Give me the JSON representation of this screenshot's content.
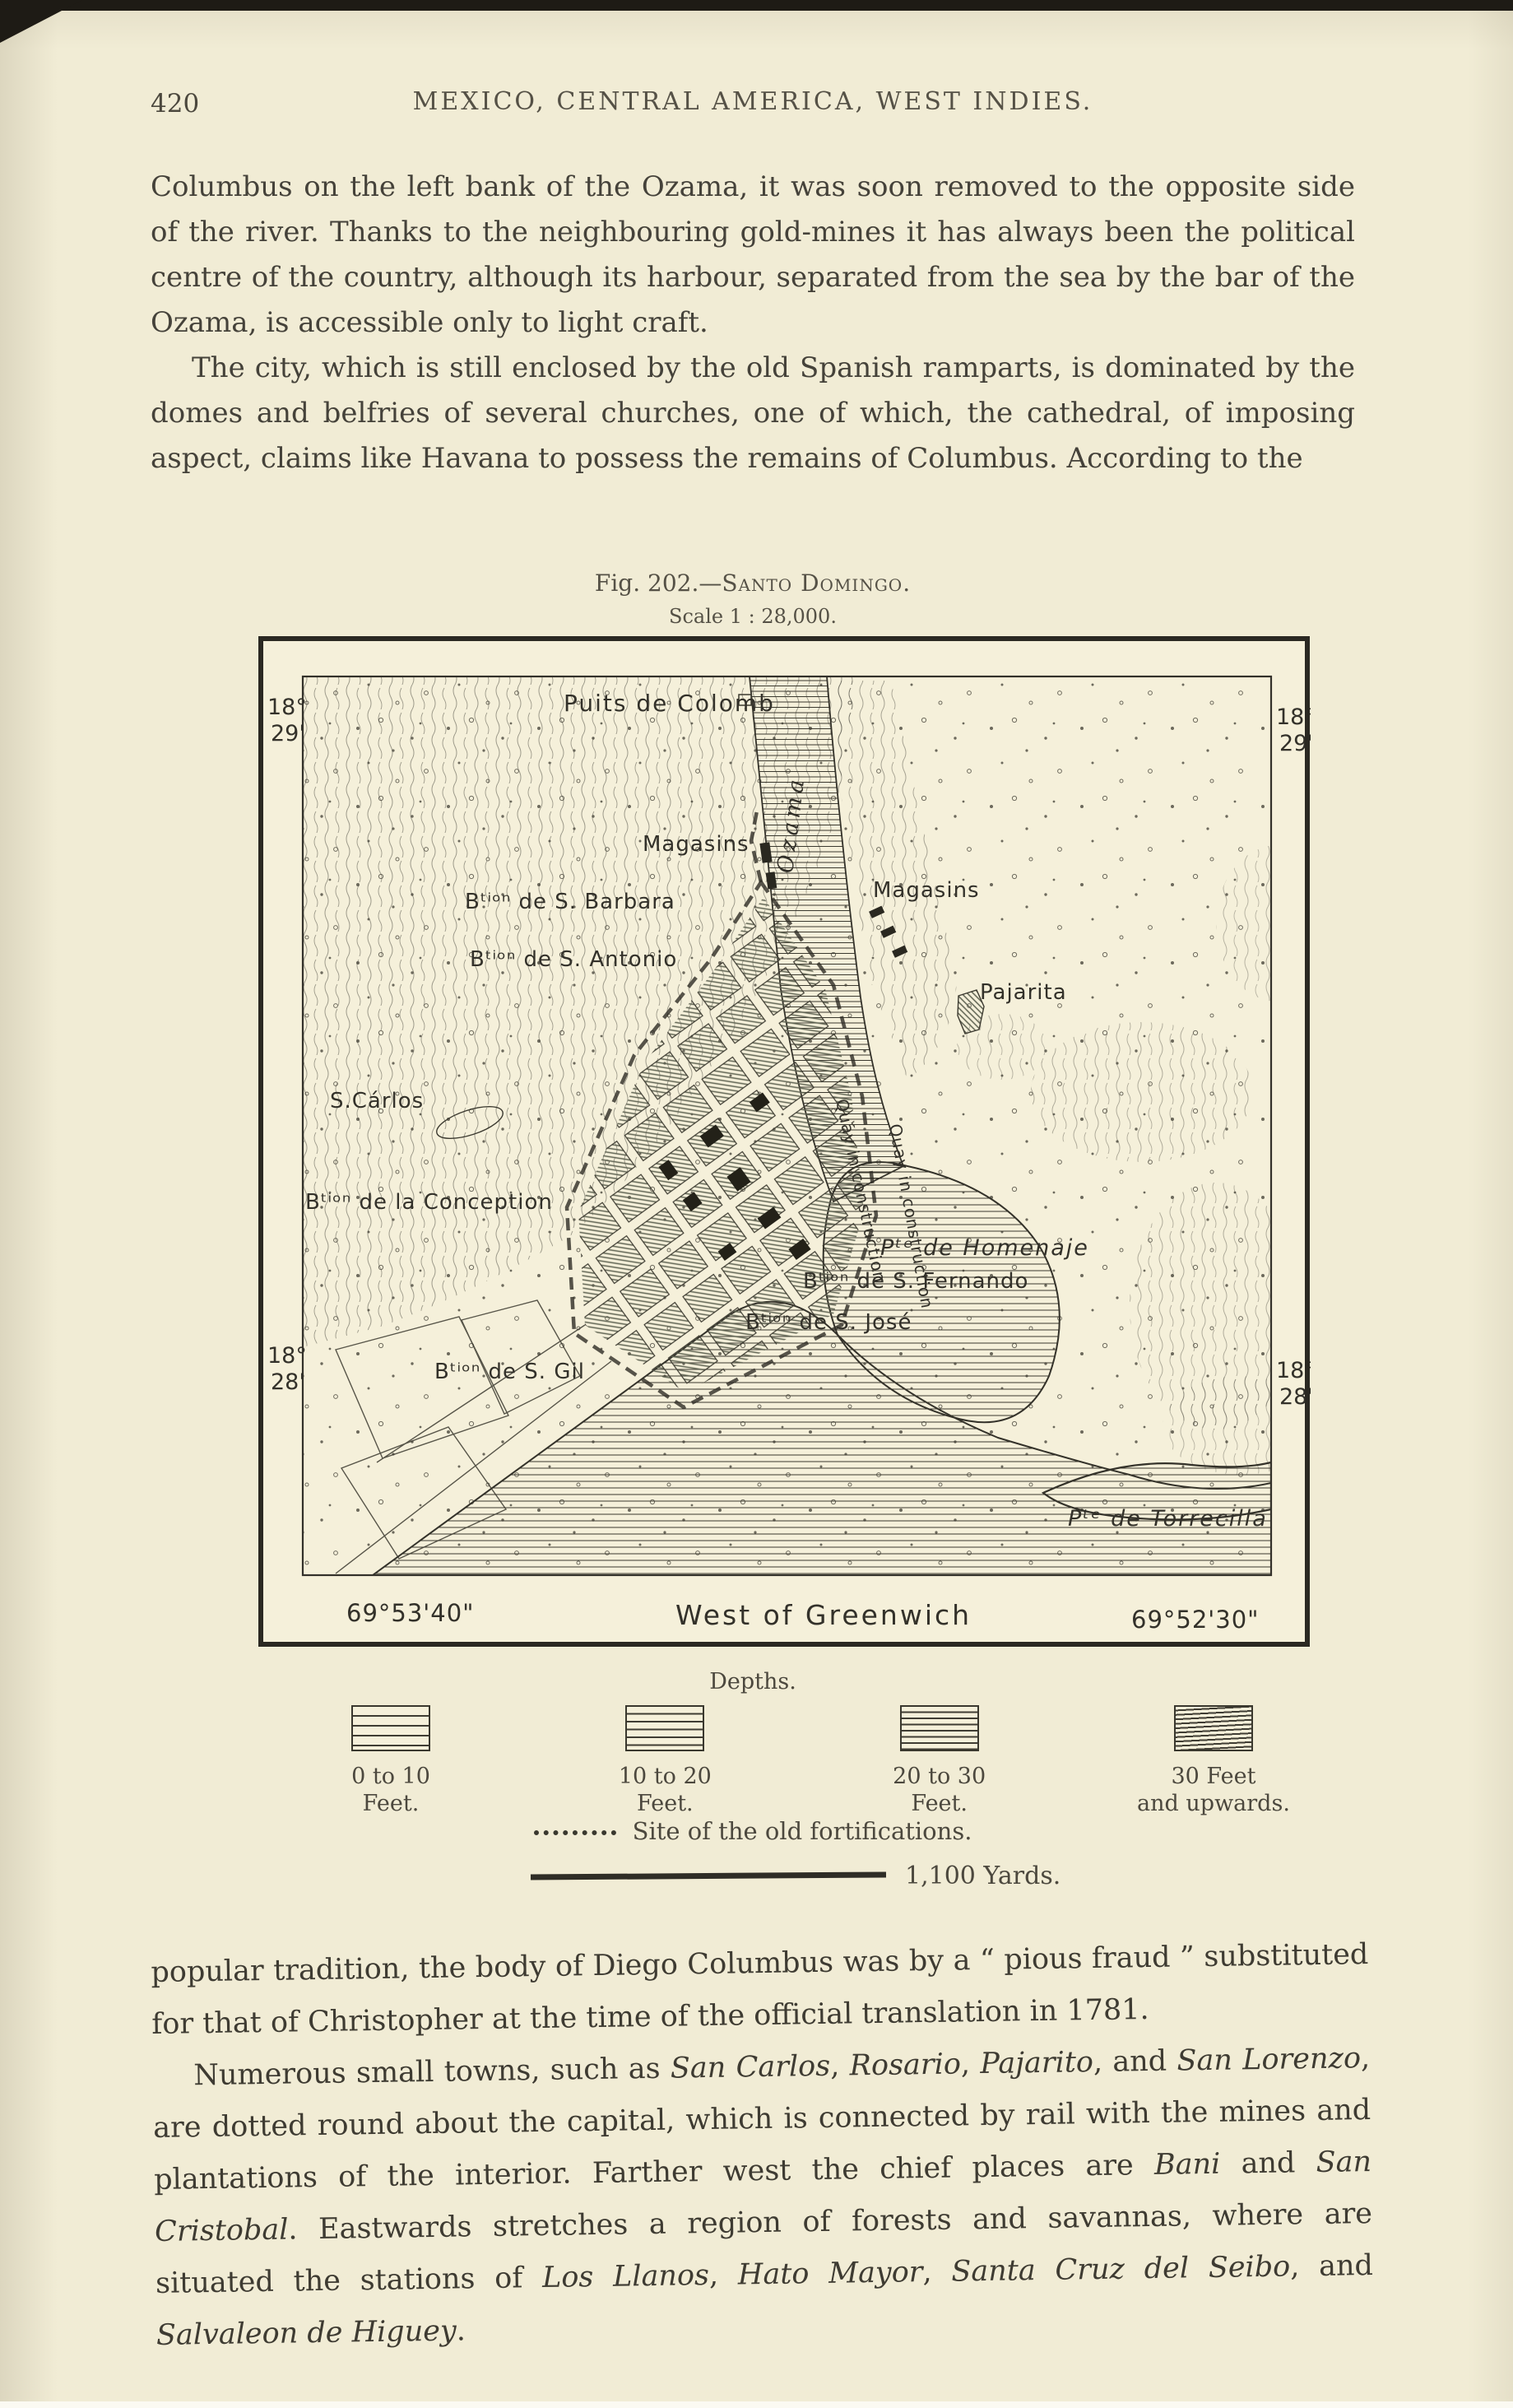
{
  "colors": {
    "paper": "#f1ecd5",
    "map_paper": "#f5f0da",
    "ink": "#3a382e"
  },
  "header": {
    "page_number": "420",
    "title": "MEXICO, CENTRAL AMERICA, WEST INDIES."
  },
  "text": {
    "p1": "Columbus on the left bank of the Ozama, it was soon removed to the opposite side of the river.  Thanks to the neighbouring gold-mines it has always been the political centre of the country, although its harbour, separated from the sea by the bar of the Ozama, is accessible only to light craft.",
    "p2": "The city, which is still enclosed by the old Spanish ramparts, is dominated by the domes and belfries of several churches, one of which, the cathedral, of imposing aspect, claims like Havana to possess the remains of Columbus.  According to the",
    "p3": "popular tradition, the body of Diego Columbus was by a “ pious fraud ” substituted for that of Christopher at the time of the official translation in 1781.",
    "p4": [
      {
        "t": "Numerous small towns, such as "
      },
      {
        "t": "San Carlos",
        "i": true
      },
      {
        "t": ", "
      },
      {
        "t": "Rosario",
        "i": true
      },
      {
        "t": ", "
      },
      {
        "t": "Pajarito",
        "i": true
      },
      {
        "t": ", and "
      },
      {
        "t": "San Lorenzo",
        "i": true
      },
      {
        "t": ", are dotted round about the capital, which is connected by rail with the mines and plantations of the interior.  Farther west the chief places are "
      },
      {
        "t": "Bani",
        "i": true
      },
      {
        "t": " and "
      },
      {
        "t": "San Cristobal",
        "i": true
      },
      {
        "t": ".  Eastwards stretches a region of forests and savannas, where are situated the stations of "
      },
      {
        "t": "Los Llanos",
        "i": true
      },
      {
        "t": ", "
      },
      {
        "t": "Hato Mayor",
        "i": true
      },
      {
        "t": ", "
      },
      {
        "t": "Santa Cruz del Seibo",
        "i": true
      },
      {
        "t": ", and "
      },
      {
        "t": "Salvaleon de Higuey",
        "i": true
      },
      {
        "t": "."
      }
    ]
  },
  "figure": {
    "caption_prefix": "Fig. 202.—",
    "caption_name": "Santo Domingo.",
    "scale_note": "Scale 1 : 28,000.",
    "map": {
      "corners": {
        "tl": {
          "deg": "18°",
          "min": "29'"
        },
        "tr": {
          "deg": "18°",
          "min": "29'"
        },
        "bl": {
          "deg": "18°",
          "min": "28'"
        },
        "br": {
          "deg": "18°",
          "min": "28'"
        }
      },
      "labels": {
        "puits": "Puits de Colomb",
        "ozama": "Ozama",
        "magasins_left": "Magasins",
        "magasins_right": "Magasins",
        "barbara": "Bᵗⁱᵒⁿ de S. Barbara",
        "antonio": "Bᵗⁱᵒⁿ de S. Antonio",
        "pajarita": "Pajarita",
        "san_carlos": "S.Cárlos",
        "conception": "Bᵗⁱᵒⁿ de la Conception",
        "homenaje": "Pᵗᵉ de Homenaje",
        "fernando": "Bᵗⁱᵒⁿ de S. Fernando",
        "jose": "Bᵗⁱᵒⁿ de S. José",
        "gil": "Bᵗⁱᵒⁿ de S. Gil",
        "torrecilla": "Pᵗᵉ de Torrecilla",
        "quay1": "Quay in construction",
        "quay2": "Quay in construction"
      },
      "bottom_left": "69°53'40\"",
      "bottom_center": "West of Greenwich",
      "bottom_right": "69°52'30\""
    }
  },
  "legend": {
    "title": "Depths.",
    "items": [
      {
        "l1": "0 to 10",
        "l2": "Feet."
      },
      {
        "l1": "10 to 20",
        "l2": "Feet."
      },
      {
        "l1": "20 to 30",
        "l2": "Feet."
      },
      {
        "l1": "30 Feet",
        "l2": "and upwards."
      }
    ],
    "fortifications": "Site of the old fortifications.",
    "scalebar_label": "1,100 Yards."
  }
}
